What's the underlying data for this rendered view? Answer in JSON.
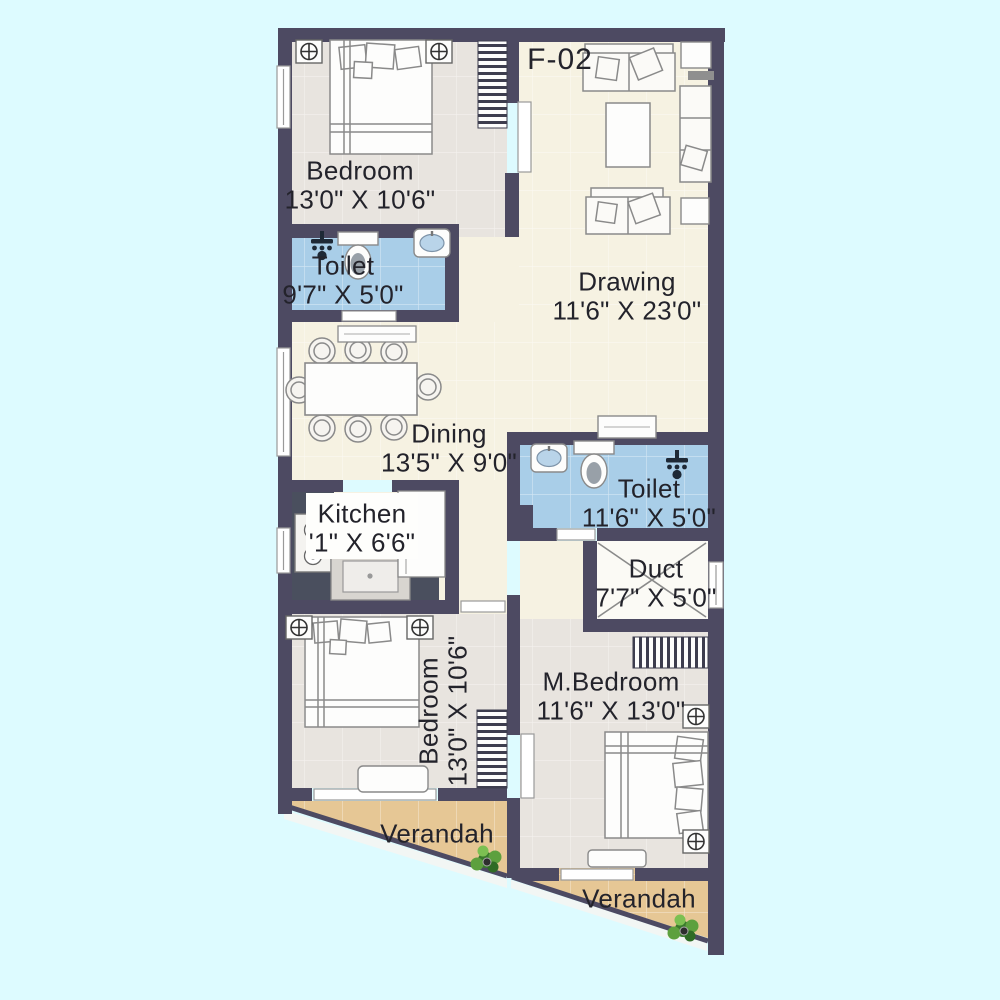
{
  "unit_label": "F-02",
  "rooms": [
    {
      "name": "Bedroom",
      "dim": "13'0\" X 10'6\""
    },
    {
      "name": "Toilet",
      "dim": "9'7\" X 5'0\""
    },
    {
      "name": "Drawing",
      "dim": "11'6\" X 23'0\""
    },
    {
      "name": "Dining",
      "dim": "13'5\" X 9'0\""
    },
    {
      "name": "Kitchen",
      "dim": "'1\" X 6'6\""
    },
    {
      "name": "Toilet",
      "dim": "11'6\" X 5'0\""
    },
    {
      "name": "Duct",
      "dim": "7'7\" X 5'0\""
    },
    {
      "name": "Bedroom",
      "dim": "13'0\" X 10'6\""
    },
    {
      "name": "M.Bedroom",
      "dim": "11'6\" X 13'0\""
    },
    {
      "name": "Verandah",
      "dim": ""
    },
    {
      "name": "Verandah",
      "dim": ""
    }
  ],
  "colors": {
    "background": "#ddfbff",
    "wall": "#4d4a62",
    "floor_living": "#f6f2e2",
    "floor_bedroom": "#e8e4df",
    "toilet": "#a9cee8",
    "verandah": "#e6c795",
    "duct": "#fbfaf5",
    "counter": "#4a4f5e",
    "plant": "#4e8f3a",
    "text": "#23232b"
  },
  "icons": {
    "shower": "shower-icon",
    "wc": "toilet-wc-icon",
    "basin": "washbasin-icon",
    "fanbox": "circle-cross-box-icon",
    "plant": "potted-plant-icon"
  }
}
